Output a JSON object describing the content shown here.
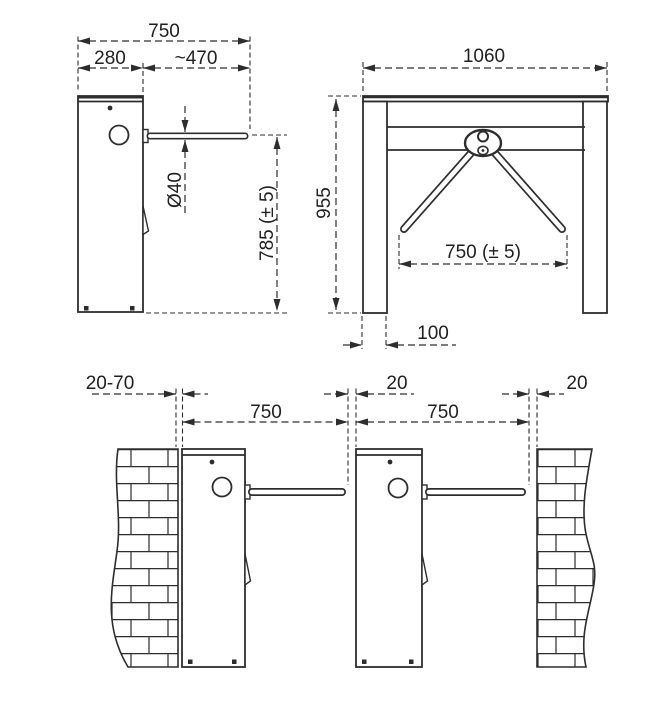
{
  "drawing": {
    "side_view": {
      "total_width": "750",
      "cabinet_depth": "280",
      "arm_length": "~470",
      "arm_diameter": "Ø40",
      "arm_height": "785 (± 5)"
    },
    "front_view": {
      "total_width": "1060",
      "total_height": "955",
      "arm_span": "750 (± 5)",
      "leg_depth": "100"
    },
    "installation_view": {
      "wall_gap_range": "20-70",
      "left_passage_width": "750",
      "center_gap": "20",
      "right_passage_width": "750",
      "right_wall_gap": "20"
    },
    "colors": {
      "line": "#2d2d2d",
      "background": "#ffffff"
    }
  }
}
